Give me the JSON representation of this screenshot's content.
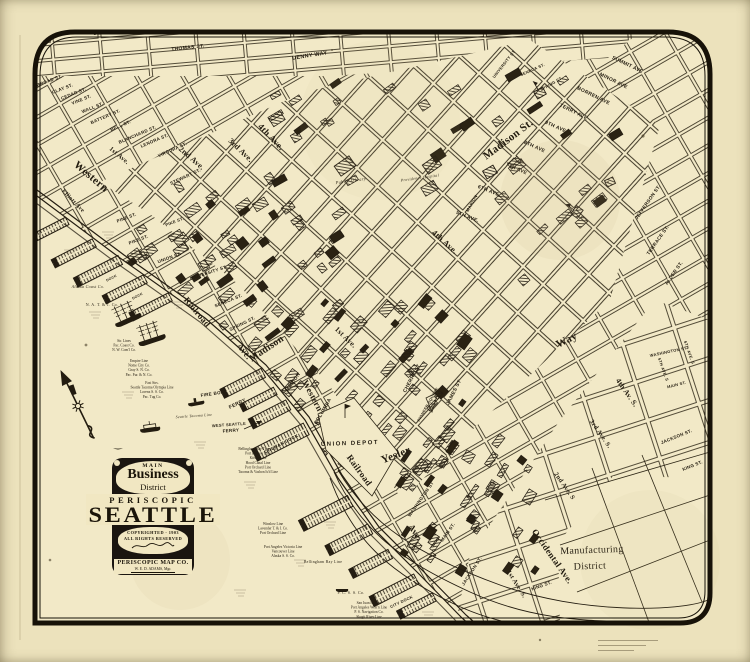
{
  "colors": {
    "paper": "#ece2bc",
    "paper_map": "#f2e9c7",
    "ink": "#231c10",
    "frame": "#171208"
  },
  "title_block": {
    "main": "MAIN",
    "business": "Business",
    "district": "District",
    "periscopic": "PERISCOPIC",
    "seattle": "SEATTLE",
    "copyright": "COPYRIGHTED - 1903",
    "rights": "ALL RIGHTS RESERVED",
    "company": "PERISCOPIC MAP CO.",
    "manager": "W. E. D. ADAMS, Mgr."
  },
  "districts": [
    {
      "t": "Manufacturing",
      "x": 592,
      "y": 553,
      "r": -2,
      "s": 10,
      "k": "sr"
    },
    {
      "t": "District",
      "x": 590,
      "y": 569,
      "r": -2,
      "s": 10,
      "k": "sr"
    }
  ],
  "labels": [
    {
      "t": "JOHN ST.",
      "x": 107,
      "y": 34,
      "r": -4,
      "s": 5.5
    },
    {
      "t": "THOMAS ST.",
      "x": 188,
      "y": 49,
      "r": -6,
      "s": 5
    },
    {
      "t": "DENNY WAY",
      "x": 310,
      "y": 57,
      "r": -9,
      "s": 5.5
    },
    {
      "t": "BROAD ST.",
      "x": 50,
      "y": 82,
      "r": -20,
      "s": 4.5
    },
    {
      "t": "CLAY ST.",
      "x": 63,
      "y": 90,
      "r": -21,
      "s": 4.5
    },
    {
      "t": "CEDAR ST.",
      "x": 74,
      "y": 95,
      "r": -22,
      "s": 4.5
    },
    {
      "t": "VINE ST.",
      "x": 82,
      "y": 101,
      "r": -22,
      "s": 4.5
    },
    {
      "t": "WALL ST.",
      "x": 93,
      "y": 109,
      "r": -22,
      "s": 4.5
    },
    {
      "t": "BATTERY ST.",
      "x": 106,
      "y": 118,
      "r": -23,
      "s": 4.5
    },
    {
      "t": "BELL ST.",
      "x": 121,
      "y": 127,
      "r": -23,
      "s": 4.5
    },
    {
      "t": "BLANCHARD ST.",
      "x": 138,
      "y": 136,
      "r": -23,
      "s": 4.5
    },
    {
      "t": "LENORA ST.",
      "x": 155,
      "y": 142,
      "r": -23,
      "s": 4.5
    },
    {
      "t": "VIRGINIA ST.",
      "x": 173,
      "y": 151,
      "r": -24,
      "s": 4.5
    },
    {
      "t": "STEWART ST.",
      "x": 186,
      "y": 178,
      "r": -25,
      "s": 4.5
    },
    {
      "t": "PINE ST.",
      "x": 127,
      "y": 219,
      "r": -21,
      "s": 4.5
    },
    {
      "t": "PIKE ST.",
      "x": 139,
      "y": 241,
      "r": -21,
      "s": 4.5
    },
    {
      "t": "PIKE ST.",
      "x": 175,
      "y": 223,
      "r": -21,
      "s": 4.2
    },
    {
      "t": "UNION ST.",
      "x": 170,
      "y": 259,
      "r": -20,
      "s": 4.5
    },
    {
      "t": "UNIVERSITY ST.",
      "x": 209,
      "y": 274,
      "r": -18,
      "s": 4.5
    },
    {
      "t": "SENECA ST.",
      "x": 229,
      "y": 302,
      "r": -22,
      "s": 4.5
    },
    {
      "t": "SPRING ST.",
      "x": 243,
      "y": 325,
      "r": -26,
      "s": 4.5
    },
    {
      "t": "MARION",
      "x": 294,
      "y": 383,
      "r": -55,
      "s": 5
    },
    {
      "t": "COLUMBIA",
      "x": 324,
      "y": 412,
      "r": -60,
      "s": 5
    },
    {
      "t": "CHERRY ST",
      "x": 413,
      "y": 379,
      "r": -62,
      "s": 5
    },
    {
      "t": "JAMES ST",
      "x": 455,
      "y": 393,
      "r": -63,
      "s": 5
    },
    {
      "t": "MARION",
      "x": 473,
      "y": 204,
      "r": -60,
      "s": 4.2
    },
    {
      "t": "UNIVERSITY ST",
      "x": 505,
      "y": 65,
      "r": -52,
      "s": 4
    },
    {
      "t": "SENECA ST.",
      "x": 533,
      "y": 71,
      "r": -24,
      "s": 4
    },
    {
      "t": "SPRING ST.",
      "x": 552,
      "y": 85,
      "r": -30,
      "s": 4
    },
    {
      "t": "JEFFERSON ST.",
      "x": 649,
      "y": 203,
      "r": -55,
      "s": 4.8
    },
    {
      "t": "TERRACE ST.",
      "x": 659,
      "y": 241,
      "r": -55,
      "s": 4.8
    },
    {
      "t": "ALDER ST.",
      "x": 675,
      "y": 274,
      "r": -55,
      "s": 4.8
    },
    {
      "t": "WASHINGTON ST",
      "x": 422,
      "y": 500,
      "r": -55,
      "s": 4.5
    },
    {
      "t": "MAIN ST.",
      "x": 449,
      "y": 533,
      "r": -55,
      "s": 4.5
    },
    {
      "t": "JACKSON ST.",
      "x": 473,
      "y": 572,
      "r": -57,
      "s": 4.5
    },
    {
      "t": "KING ST.",
      "x": 542,
      "y": 587,
      "r": -20,
      "s": 4.5
    },
    {
      "t": "WASHINGTON ST.",
      "x": 669,
      "y": 353,
      "r": -12,
      "s": 4
    },
    {
      "t": "MAIN ST.",
      "x": 677,
      "y": 386,
      "r": -14,
      "s": 4
    },
    {
      "t": "JACKSON ST.",
      "x": 677,
      "y": 438,
      "r": -22,
      "s": 4.5
    },
    {
      "t": "KING ST.",
      "x": 693,
      "y": 467,
      "r": -22,
      "s": 4.5
    },
    {
      "t": "5TH AVE. S",
      "x": 662,
      "y": 370,
      "r": 70,
      "s": 4
    },
    {
      "t": "6TH AVE. S",
      "x": 688,
      "y": 353,
      "r": 70,
      "s": 4
    },
    {
      "t": "PIONEER SQUARE",
      "x": 429,
      "y": 405,
      "r": -60,
      "s": 3.8
    },
    {
      "t": "UNION DEPOT",
      "x": 350,
      "y": 445,
      "r": -2,
      "s": 6,
      "ls": 1.5
    },
    {
      "t": "FIRE BOAT",
      "x": 214,
      "y": 395,
      "r": -8,
      "s": 4.5
    },
    {
      "t": "FERRY",
      "x": 238,
      "y": 405,
      "r": -26,
      "s": 5
    },
    {
      "t": "WEST SEATTLE",
      "x": 229,
      "y": 426,
      "r": -4,
      "s": 4
    },
    {
      "t": "FERRY",
      "x": 231,
      "y": 432,
      "r": -4,
      "s": 4.5
    },
    {
      "t": "COLMAN DOCK",
      "x": 282,
      "y": 445,
      "r": -27,
      "s": 4.5
    },
    {
      "t": "CITY DOCK",
      "x": 402,
      "y": 603,
      "r": -25,
      "s": 4
    },
    {
      "t": "DOCK",
      "x": 112,
      "y": 279,
      "r": -27,
      "s": 3.5
    },
    {
      "t": "DOCK",
      "x": 138,
      "y": 297,
      "r": -27,
      "s": 3.5
    },
    {
      "t": "Western",
      "x": 89,
      "y": 179,
      "r": 40,
      "s": 11,
      "k": "se"
    },
    {
      "t": "Western",
      "x": 310,
      "y": 397,
      "r": 62,
      "s": 9,
      "k": "se"
    },
    {
      "t": "Elliott Ave",
      "x": 72,
      "y": 202,
      "r": 46,
      "s": 6,
      "k": "se"
    },
    {
      "t": "Madison",
      "x": 268,
      "y": 351,
      "r": -34,
      "s": 10,
      "k": "se"
    },
    {
      "t": "Madison St.",
      "x": 510,
      "y": 142,
      "r": -37,
      "s": 11,
      "k": "se"
    },
    {
      "t": "Yesler",
      "x": 397,
      "y": 458,
      "r": -21,
      "s": 11,
      "k": "se"
    },
    {
      "t": "Way",
      "x": 568,
      "y": 343,
      "r": -27,
      "s": 11,
      "k": "se"
    },
    {
      "t": "Railroad",
      "x": 195,
      "y": 314,
      "r": 50,
      "s": 9,
      "k": "se"
    },
    {
      "t": "Ave.",
      "x": 242,
      "y": 353,
      "r": 52,
      "s": 9,
      "k": "se"
    },
    {
      "t": "Railroad",
      "x": 357,
      "y": 472,
      "r": 54,
      "s": 9,
      "k": "se"
    },
    {
      "t": "Ave.",
      "x": 413,
      "y": 534,
      "r": 56,
      "s": 9,
      "k": "se"
    },
    {
      "t": "Occidental Ave.",
      "x": 550,
      "y": 558,
      "r": 55,
      "s": 9,
      "k": "se"
    },
    {
      "t": "1st Ave.",
      "x": 118,
      "y": 157,
      "r": 40,
      "s": 6.5,
      "k": "se"
    },
    {
      "t": "2nd Ave.",
      "x": 190,
      "y": 160,
      "r": 41,
      "s": 8,
      "k": "se"
    },
    {
      "t": "3rd Ave.",
      "x": 239,
      "y": 152,
      "r": 44,
      "s": 8,
      "k": "se"
    },
    {
      "t": "4th Ave.",
      "x": 269,
      "y": 139,
      "r": 46,
      "s": 9,
      "k": "se"
    },
    {
      "t": "1st Ave.",
      "x": 344,
      "y": 339,
      "r": 44,
      "s": 7.5,
      "k": "se"
    },
    {
      "t": "4th Ave.",
      "x": 443,
      "y": 244,
      "r": 42,
      "s": 8.5,
      "k": "se"
    },
    {
      "t": "2nd Ave. S",
      "x": 563,
      "y": 487,
      "r": 55,
      "s": 6.5,
      "k": "se"
    },
    {
      "t": "3rd Ave. S.",
      "x": 599,
      "y": 435,
      "r": 55,
      "s": 6.5,
      "k": "se"
    },
    {
      "t": "4th Av. S.",
      "x": 625,
      "y": 394,
      "r": 55,
      "s": 7.5,
      "k": "se"
    },
    {
      "t": "1st Ave. S.",
      "x": 515,
      "y": 585,
      "r": 58,
      "s": 6.5,
      "k": "se"
    },
    {
      "t": "5TH AVE.",
      "x": 467,
      "y": 218,
      "r": 22,
      "s": 5
    },
    {
      "t": "6TH AVE",
      "x": 488,
      "y": 192,
      "r": 22,
      "s": 5
    },
    {
      "t": "7TH AVE",
      "x": 516,
      "y": 170,
      "r": 24,
      "s": 5
    },
    {
      "t": "8TH AVE",
      "x": 534,
      "y": 148,
      "r": 24,
      "s": 5
    },
    {
      "t": "9TH AVE",
      "x": 555,
      "y": 128,
      "r": 24,
      "s": 5
    },
    {
      "t": "TERRY AVE",
      "x": 573,
      "y": 113,
      "r": 26,
      "s": 5
    },
    {
      "t": "BORREN AVE",
      "x": 593,
      "y": 97,
      "r": 26,
      "s": 5
    },
    {
      "t": "MINOR AVE",
      "x": 613,
      "y": 82,
      "r": 26,
      "s": 5
    },
    {
      "t": "SUMMIT AVE",
      "x": 627,
      "y": 66,
      "r": 26,
      "s": 5
    },
    {
      "t": "Public Library",
      "x": 351,
      "y": 182,
      "r": -8,
      "s": 4.5,
      "k": "si"
    },
    {
      "t": "Providence Hospital",
      "x": 420,
      "y": 179,
      "r": -8,
      "s": 4,
      "k": "si"
    },
    {
      "t": "Seattle Tacoma Line",
      "x": 194,
      "y": 417,
      "r": -4,
      "s": 3.8,
      "k": "si"
    },
    {
      "t": "Alaska Coast Co.",
      "x": 88,
      "y": 288,
      "r": 0,
      "s": 4,
      "k": "si"
    },
    {
      "t": "N. A. T. & T. Co.",
      "x": 102,
      "y": 306,
      "r": 0,
      "s": 4,
      "k": "sr"
    },
    {
      "t": "P. C. S. S. Co.",
      "x": 351,
      "y": 594,
      "r": 0,
      "s": 4,
      "k": "sr"
    },
    {
      "t": "Bellingham Bay Line",
      "x": 323,
      "y": 563,
      "r": 0,
      "s": 3.8,
      "k": "sr"
    }
  ],
  "shipping_stacks": [
    {
      "x": 124,
      "y": 342,
      "lines": [
        "Str. Lines",
        "Pac. Coast Co.",
        "N. W. Com'l Co."
      ]
    },
    {
      "x": 139,
      "y": 362,
      "lines": [
        "Empire Line",
        "Nome City Co.",
        "Gray S. N. Co.",
        "Pac. Fur. & N. Co."
      ]
    },
    {
      "x": 152,
      "y": 384,
      "lines": [
        "Fast Strs.",
        "Seattle Tacoma Olympia Line",
        "Lorenz S. S. Co.",
        "Pac. Tug Co."
      ]
    },
    {
      "x": 258,
      "y": 450,
      "lines": [
        "Bellingham Bay Trans. Co.",
        "Port Blakely Line",
        "Kitsap Line",
        "Hood Canal Line",
        "Port Orchard Line",
        "Tacoma & Vashon Is'd Line"
      ]
    },
    {
      "x": 273,
      "y": 525,
      "lines": [
        "Winslow Line",
        "Lavender T. & I. Co.",
        "Port Orchard Line"
      ]
    },
    {
      "x": 283,
      "y": 548,
      "lines": [
        "Port Angeles Victoria Line",
        "Vancouver Line",
        "Alaska S. S. Co."
      ]
    },
    {
      "x": 369,
      "y": 604,
      "lines": [
        "San Juan Is. Line",
        "Port Angeles West'n Line",
        "P. S. Navigation Co.",
        "Skagit River Line"
      ]
    }
  ]
}
